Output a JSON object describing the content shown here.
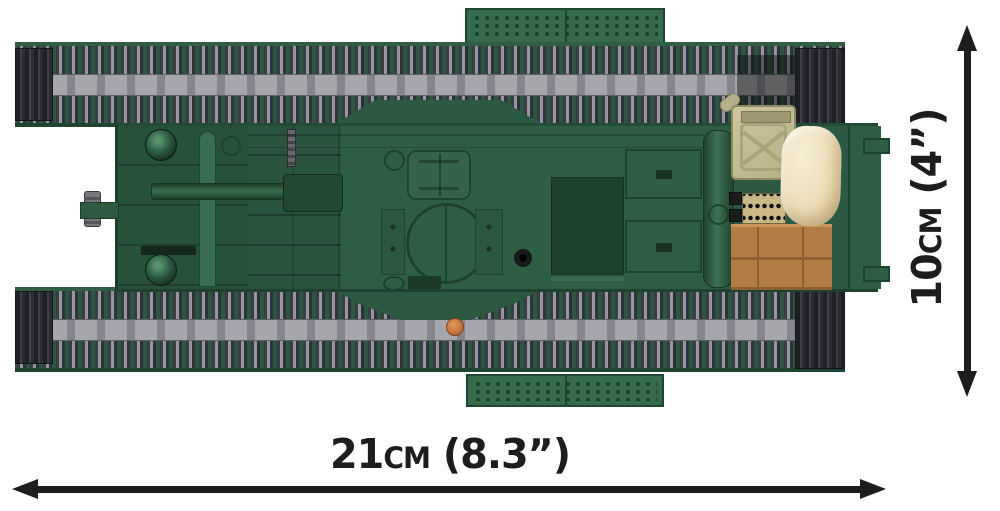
{
  "figure": {
    "subject": "Brick-built tank model, top view, dimensional product diagram",
    "width_label": "21cm (8.3”)",
    "height_label": "10cm (4”)"
  },
  "colors": {
    "background": "#ffffff",
    "annotation": "#1d1d1b",
    "hull_green": "#2e5f45",
    "hull_dark_green": "#27523a",
    "track_green": "#2b5740",
    "track_gray_light": "#9597a0",
    "track_gray_dark": "#30313b",
    "track_end_cap": "#23242b",
    "stud_plate_green": "#356a4a",
    "jerry_can_khaki": "#c2bc90",
    "sandbag_cream": "#eedcb6",
    "crate_brown": "#b27d45",
    "ammo_belt_tan": "#cab987",
    "stud_orange": "#c37538"
  },
  "parts": [
    "upper track",
    "lower track",
    "hull",
    "gun barrel",
    "muzzle cap",
    "headlight domes",
    "crew hatch",
    "turret ring",
    "periscope",
    "engine deck panel",
    "exhaust pillar",
    "jerry can",
    "sandbag",
    "ammo belt",
    "wooden crate",
    "orange stud",
    "tow lugs",
    "stud plates"
  ]
}
